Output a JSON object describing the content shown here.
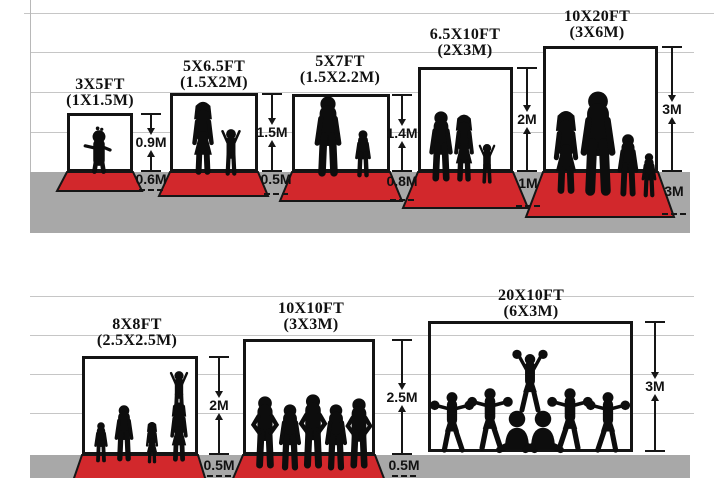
{
  "diagram_title": "Backdrop and floor size comparison chart",
  "colors": {
    "carpet_red": "#d2282c",
    "ground_gray": "#a8a8a8",
    "guide_line_gray": "#c6c6c6",
    "ink_black": "#141414"
  },
  "panels": [
    {
      "id": "3x5ft",
      "ft": "3X5FT",
      "m": "(1X1.5M)",
      "h": "0.9M",
      "d": "0.6M",
      "figures": "toddler-silhouette"
    },
    {
      "id": "5x6.5ft",
      "ft": "5X6.5FT",
      "m": "(1.5X2M)",
      "h": "1.5M",
      "d": "0.5M",
      "figures": "mother-and-child-silhouette"
    },
    {
      "id": "5x7ft",
      "ft": "5X7FT",
      "m": "(1.5X2.2M)",
      "h": "1.4M",
      "d": "0.8M",
      "figures": "father-and-son-silhouette"
    },
    {
      "id": "6.5x10ft",
      "ft": "6.5X10FT",
      "m": "(2X3M)",
      "h": "2M",
      "d": "1M",
      "figures": "family-of-three-silhouette"
    },
    {
      "id": "10x20ft",
      "ft": "10X20FT",
      "m": "(3X6M)",
      "h": "3M",
      "d": "3M",
      "figures": "family-of-four-silhouette"
    },
    {
      "id": "8x8ft",
      "ft": "8X8FT",
      "m": "(2.5X2.5M)",
      "h": "2M",
      "d": "0.5M",
      "figures": "family-with-child-on-shoulders-silhouette"
    },
    {
      "id": "10x10ft",
      "ft": "10X10FT",
      "m": "(3X3M)",
      "h": "2.5M",
      "d": "0.5M",
      "figures": "sports-team-silhouette"
    },
    {
      "id": "20x10ft",
      "ft": "20X10FT",
      "m": "(6X3M)",
      "h": "3M",
      "d": "",
      "figures": "cheerleading-squad-silhouette"
    }
  ]
}
